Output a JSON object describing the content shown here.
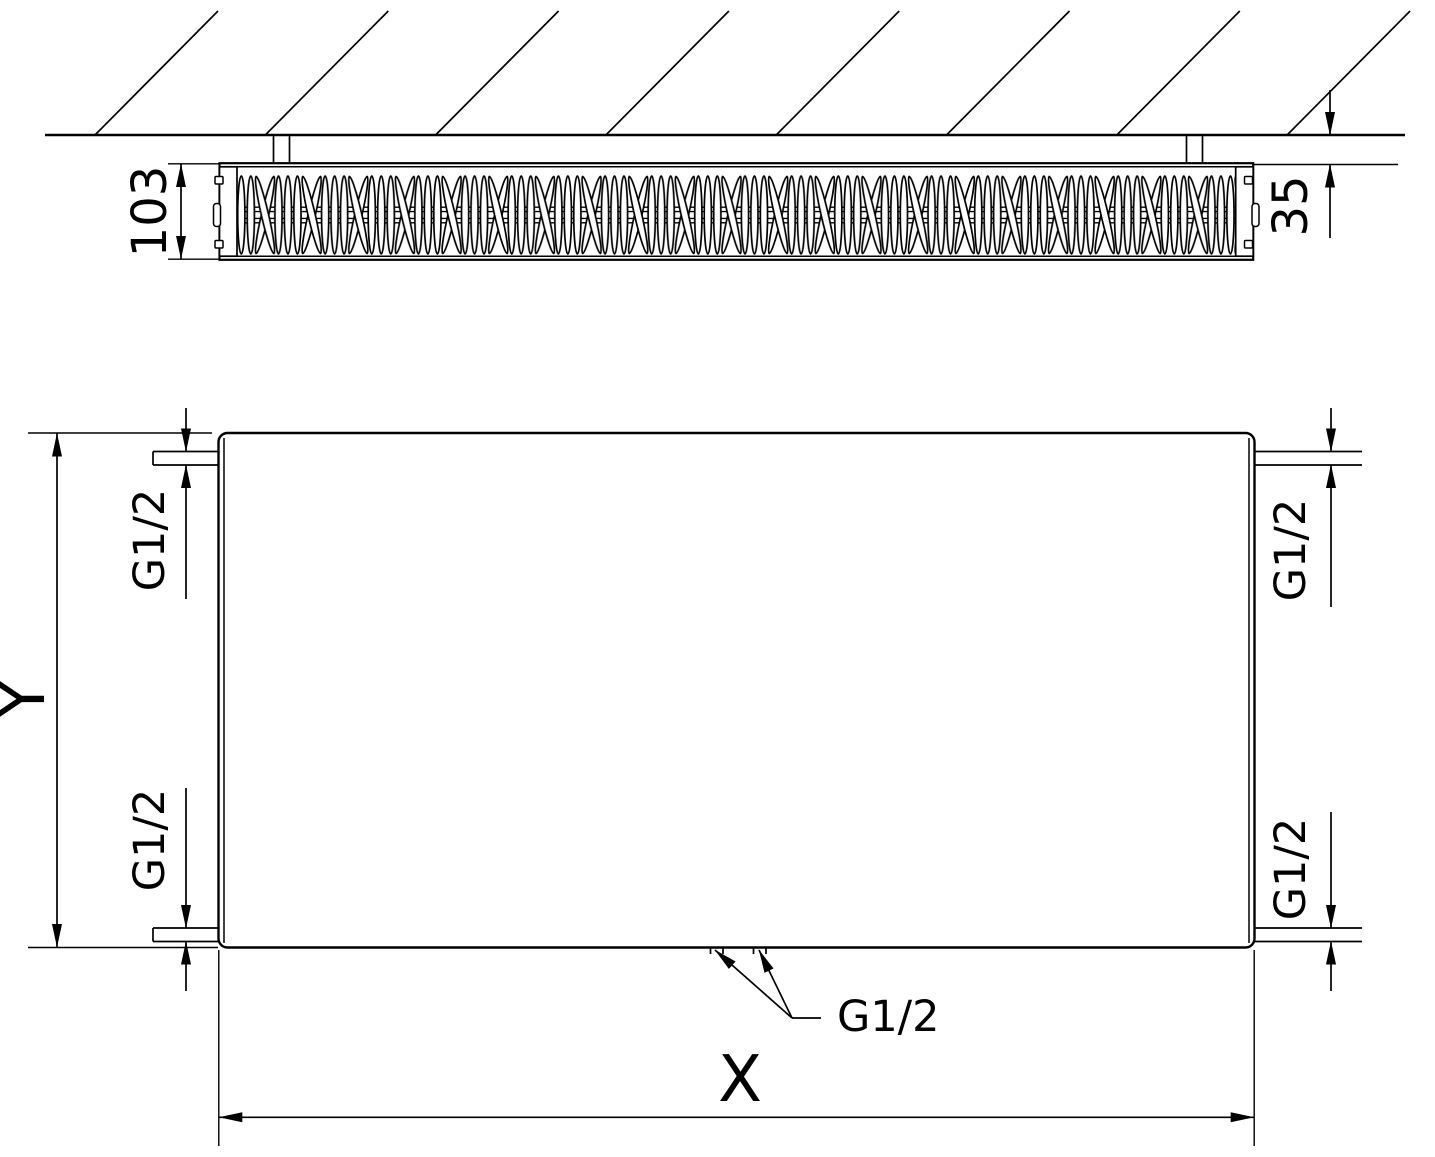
{
  "top_view": {
    "depth_label": "103",
    "wall_clearance_label": "35"
  },
  "front_view": {
    "height_label": "Y",
    "width_label": "X",
    "connection_top_left": "G1/2",
    "connection_top_right": "G1/2",
    "connection_bottom_left": "G1/2",
    "connection_bottom_right": "G1/2",
    "connection_bottom_center": "G1/2"
  }
}
